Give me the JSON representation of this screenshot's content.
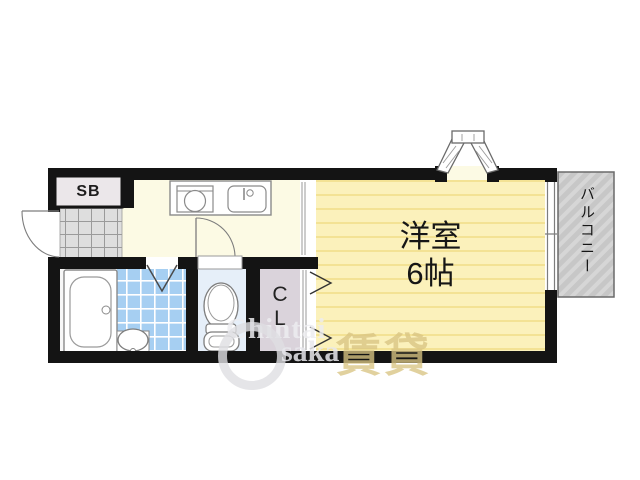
{
  "floor_plan": {
    "shoe_box_label": "SB",
    "room": {
      "name": "洋室",
      "size": "6帖"
    },
    "balcony_label": "バルコニー",
    "closet": {
      "line1": "C",
      "line2": "L"
    },
    "watermark": {
      "text1": "Chintai",
      "text2": "saka",
      "text3": "賃貸"
    },
    "colors": {
      "wall": "#141414",
      "room_yellow": "#FBF1BB",
      "room_stripe": "#F3E294",
      "kitchen_cream": "#FCFAE4",
      "bath_tile_blue": "#A6CFF2",
      "toilet_floor": "#E6EFF9",
      "closet_floor": "#DAD3DB",
      "entrance_tile_gray": "#DEDEDE",
      "balcony_gray": "#C7C7C7",
      "shoe_box_fill": "#EBE7EA"
    }
  }
}
